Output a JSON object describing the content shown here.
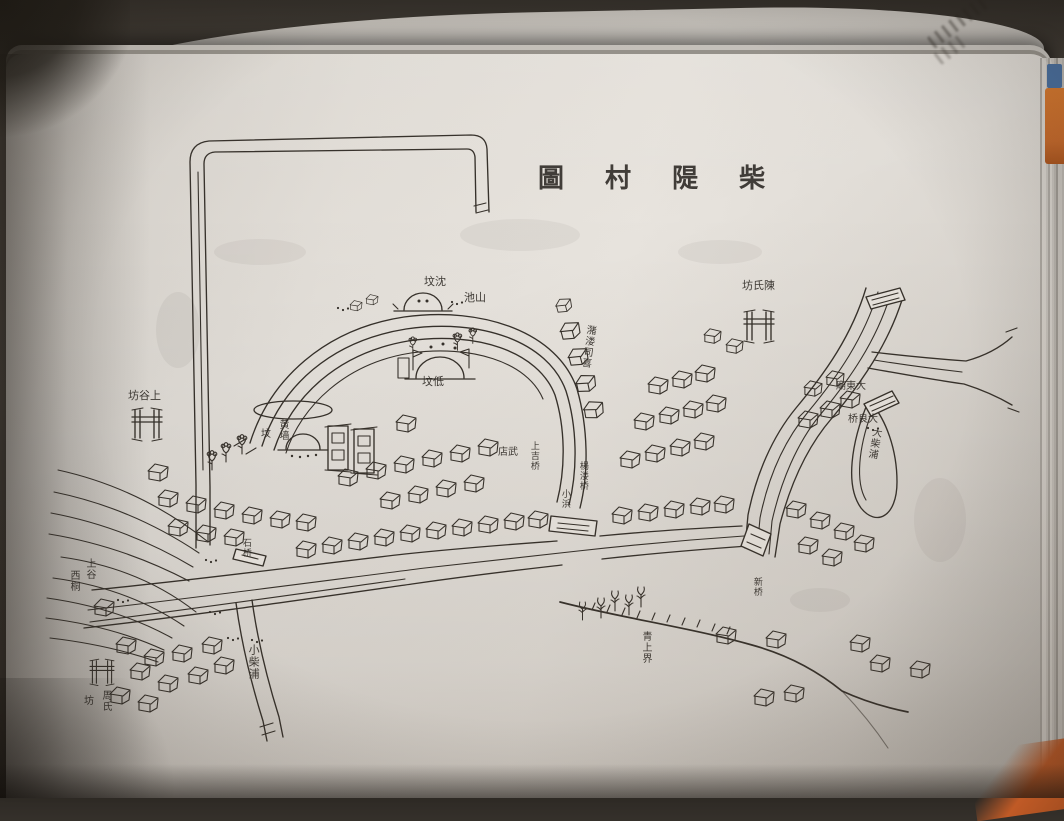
{
  "book": {
    "map_title_display": "圖 村 隄 柴",
    "map_title_reading_rtl": "柴隄村圖"
  },
  "colors": {
    "ink": "#35302a",
    "paper": "#e6e2dc",
    "backdrop": "#47413a",
    "cover_orange": "#c4692c",
    "cover_blue": "#4a6f9e"
  },
  "map": {
    "labels": [
      {
        "text": "坟沈",
        "x": 424,
        "y": 276
      },
      {
        "text": "池山",
        "x": 464,
        "y": 292
      },
      {
        "text": "坟低",
        "x": 422,
        "y": 376
      },
      {
        "text": "坊氏陳",
        "x": 742,
        "y": 280
      },
      {
        "text": "坊谷上",
        "x": 128,
        "y": 390
      },
      {
        "text": "黄墙",
        "x": 277,
        "y": 419,
        "v": true,
        "size": 10
      },
      {
        "text": "坟",
        "x": 261,
        "y": 429,
        "size": 10
      },
      {
        "text": "店武",
        "x": 498,
        "y": 447,
        "size": 10
      },
      {
        "text": "上吉桥",
        "x": 528,
        "y": 441,
        "v": true,
        "size": 9
      },
      {
        "text": "潴溇司喜",
        "x": 585,
        "y": 324,
        "v": true,
        "size": 10,
        "rot": 8
      },
      {
        "text": "楊溇桥",
        "x": 577,
        "y": 461,
        "v": true,
        "size": 9
      },
      {
        "text": "小浜",
        "x": 559,
        "y": 489,
        "v": true,
        "size": 9
      },
      {
        "text": "石桥",
        "x": 240,
        "y": 538,
        "v": true,
        "size": 9
      },
      {
        "text": "小柴浦",
        "x": 247,
        "y": 644,
        "v": true,
        "size": 11
      },
      {
        "text": "上谷",
        "x": 84,
        "y": 558,
        "v": true,
        "size": 10
      },
      {
        "text": "西桐",
        "x": 68,
        "y": 570,
        "v": true,
        "size": 10
      },
      {
        "text": "周氏",
        "x": 100,
        "y": 690,
        "v": true,
        "size": 10
      },
      {
        "text": "坊",
        "x": 84,
        "y": 696,
        "size": 10
      },
      {
        "text": "大柴浦",
        "x": 871,
        "y": 426,
        "v": true,
        "size": 10,
        "rot": 10
      },
      {
        "text": "桥良大",
        "x": 848,
        "y": 414,
        "size": 10
      },
      {
        "text": "廟東大",
        "x": 836,
        "y": 381,
        "size": 10
      },
      {
        "text": "青上界",
        "x": 640,
        "y": 631,
        "v": true,
        "size": 10
      },
      {
        "text": "新桥",
        "x": 751,
        "y": 577,
        "v": true,
        "size": 9
      }
    ]
  }
}
